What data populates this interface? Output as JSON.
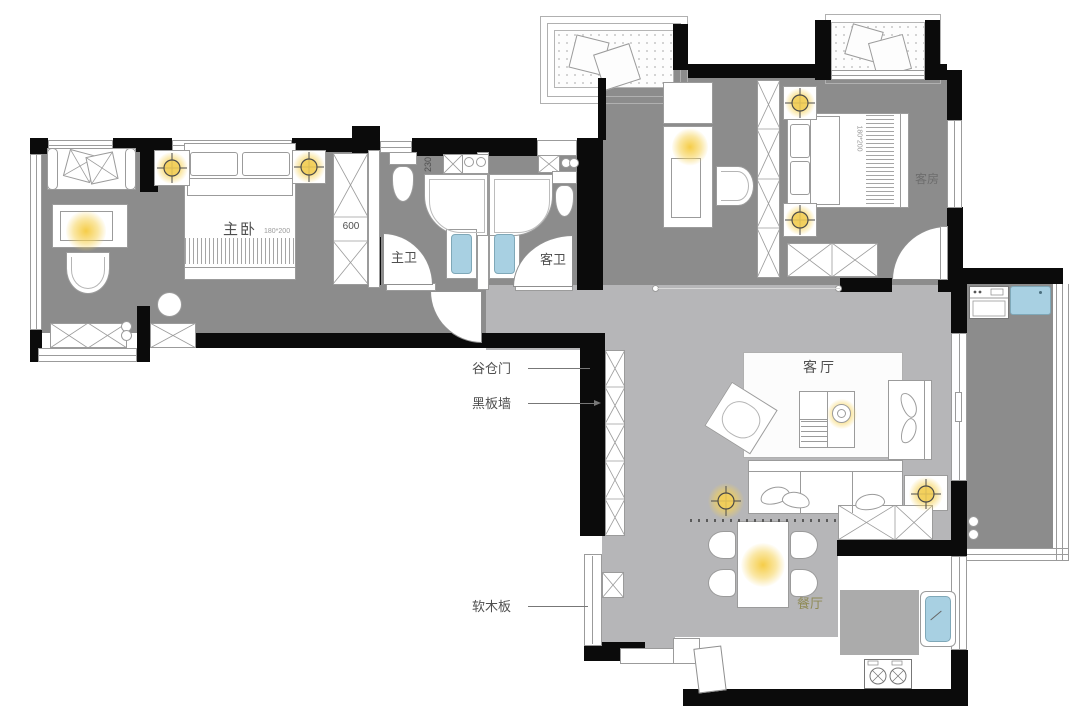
{
  "rooms": {
    "master_bedroom": "主卧",
    "master_bath": "主卫",
    "guest_bath": "客卫",
    "guest_room": "客房",
    "living_room": "客厅",
    "dining_room": "餐厅"
  },
  "callouts": {
    "barn_door": "谷仓门",
    "blackboard_wall": "黑板墙",
    "cork_board": "软木板"
  },
  "dimensions": {
    "wardrobe_depth": "600",
    "counter_width": "230",
    "master_bed_size": "180*200",
    "guest_bed_size": "180*200"
  },
  "icons": {
    "ceiling_light": "crosshair-circle-light",
    "washer": "washing-machine",
    "stove": "two-burner-stove",
    "kitchen_sink": "sink-basin",
    "bath_basin": "washbasin",
    "toilet": "toilet",
    "shower": "shower-stall"
  },
  "colors": {
    "wall": "#0b0b0b",
    "floor_dark": "#8c8c8c",
    "floor_light": "#b6b6b8",
    "balcony_floor": "#fdfdfd",
    "fixture_blue": "#a8d0e2",
    "light_glow": "#f2cf5b",
    "label_text": "#4f4f4f",
    "dining_label": "#8f8a55"
  }
}
